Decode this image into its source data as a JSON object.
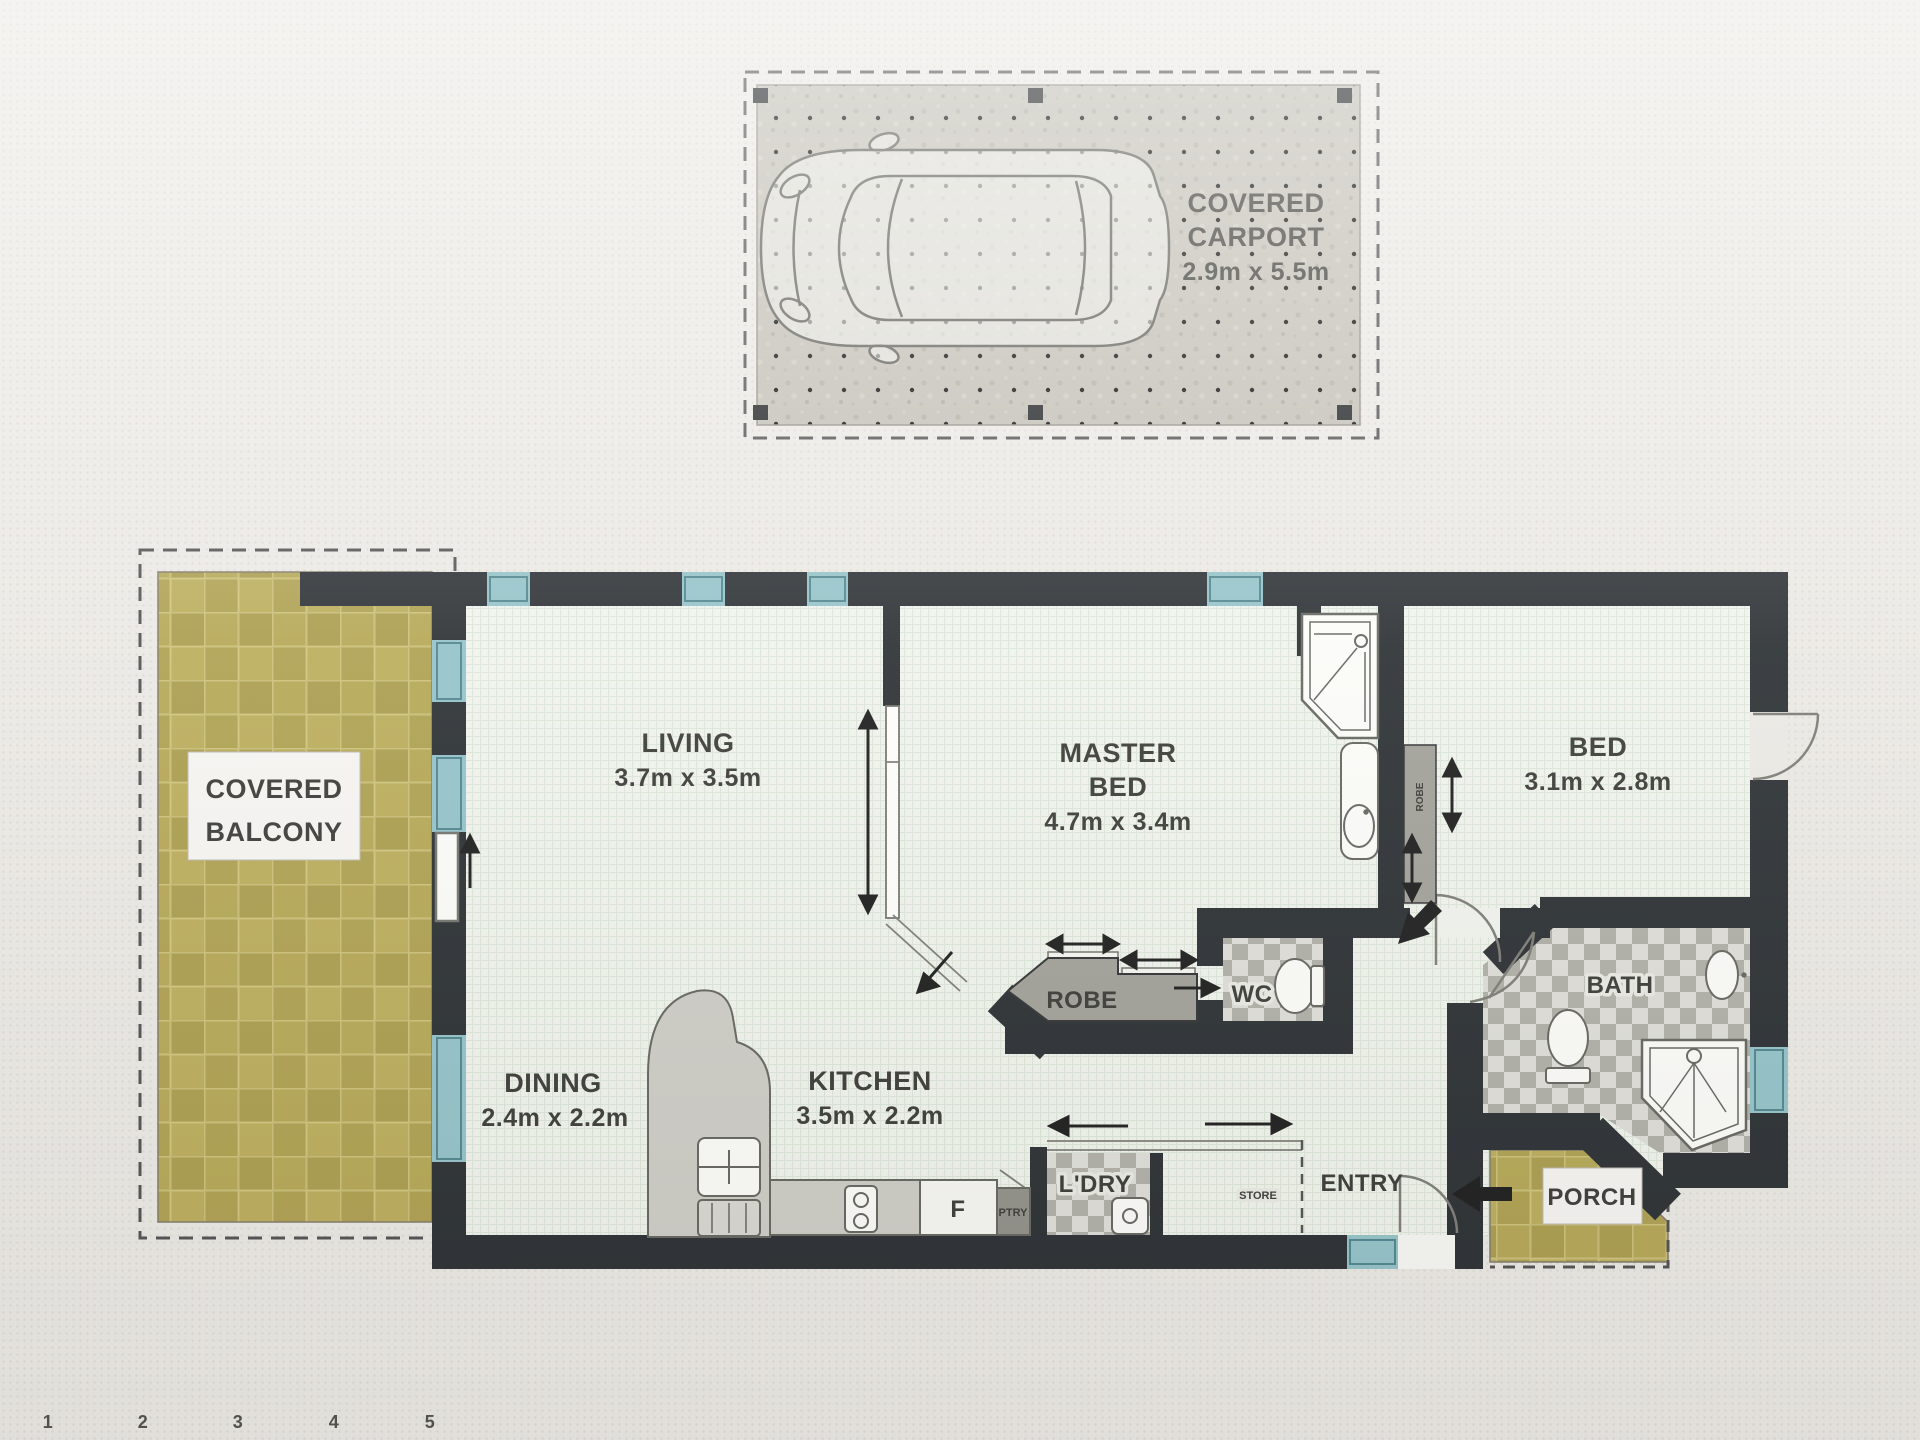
{
  "carport": {
    "title_line1": "COVERED",
    "title_line2": "CARPORT",
    "dims": "2.9m x 5.5m"
  },
  "balcony": {
    "line1": "COVERED",
    "line2": "BALCONY"
  },
  "rooms": {
    "living": {
      "name": "LIVING",
      "dims": "3.7m x 3.5m"
    },
    "master_bed": {
      "line1": "MASTER",
      "line2": "BED",
      "dims": "4.7m x 3.4m"
    },
    "bed": {
      "name": "BED",
      "dims": "3.1m x 2.8m"
    },
    "dining": {
      "name": "DINING",
      "dims": "2.4m x 2.2m"
    },
    "kitchen": {
      "name": "KITCHEN",
      "dims": "3.5m x 2.2m"
    }
  },
  "labels": {
    "robe": "ROBE",
    "robe2": "ROBE",
    "wc": "WC",
    "bath": "BATH",
    "laundry": "L'DRY",
    "pantry": "PTRY",
    "store": "STORE",
    "entry": "ENTRY",
    "porch": "PORCH",
    "fridge": "F"
  },
  "scale_ruler": {
    "marks": [
      "1",
      "2",
      "3",
      "4",
      "5"
    ]
  },
  "colors": {
    "wall": "#22272b",
    "window": "#8fc0c6",
    "tile": "#b1a24c",
    "floor": "#eff2ec",
    "carport_slab": "#bfbcb1"
  }
}
